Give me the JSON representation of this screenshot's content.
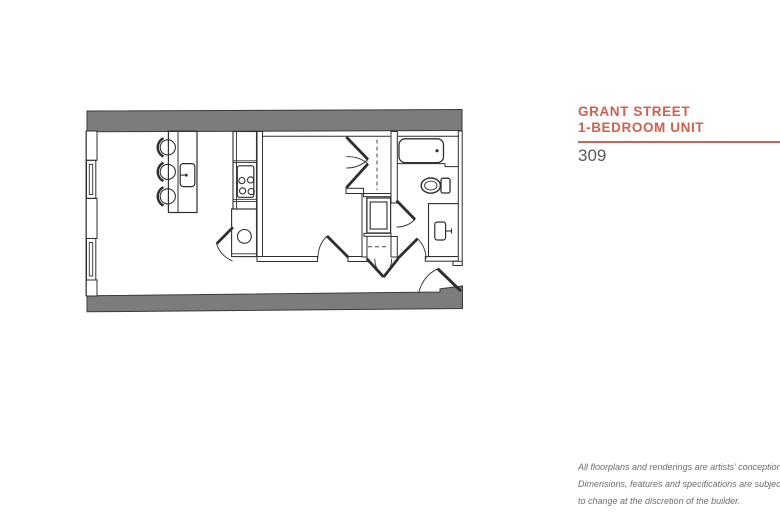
{
  "colors": {
    "accent": "#d2604d",
    "wall_gray": "#7c7c7c",
    "line_dark": "#2f2f2f",
    "unit_number_gray": "#58595b",
    "disclaimer_gray": "#6d6e71",
    "background": "#ffffff"
  },
  "header": {
    "title_line1": "GRANT STREET",
    "title_line2": "1-BEDROOM UNIT",
    "unit_number": "309"
  },
  "floorplan": {
    "name": "grant-street-1-bedroom-unit-floorplan",
    "fixtures": [
      "kitchen-island",
      "bar-stools",
      "island-sink",
      "cooktop-4-burner",
      "refrigerator-counter",
      "kitchen-round-sink",
      "swing-door",
      "bedroom",
      "closet-bifold-doors",
      "closet-rod-dashed",
      "washer-dryer-stack",
      "linen-closet-double-doors",
      "bathtub",
      "toilet",
      "vanity-with-sink",
      "bathroom-door",
      "entry-door",
      "windows",
      "exterior-walls"
    ]
  },
  "disclaimer": {
    "line1": "All floorplans and renderings are artists’ conception.",
    "line2": "Dimensions, features and specifications are subject",
    "line3": "to change at the discretion of the builder."
  }
}
